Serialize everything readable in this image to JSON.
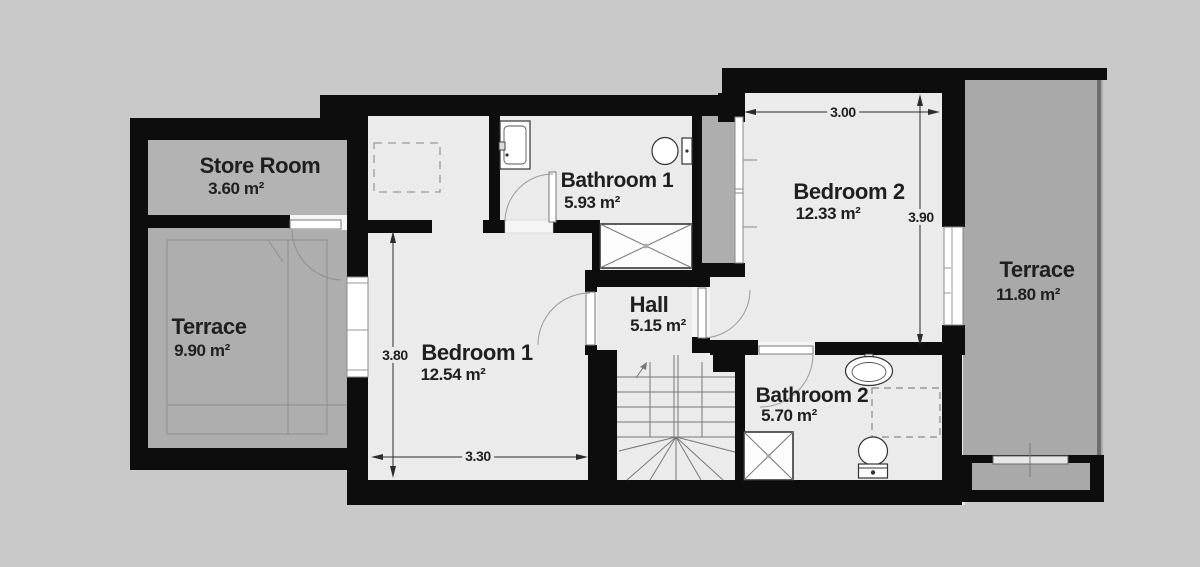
{
  "plan": {
    "type": "floor-plan",
    "rooms": [
      {
        "id": "store-room",
        "name": "Store Room",
        "area": "3.60 m²"
      },
      {
        "id": "terrace-left",
        "name": "Terrace",
        "area": "9.90 m²"
      },
      {
        "id": "bedroom-1",
        "name": "Bedroom 1",
        "area": "12.54 m²"
      },
      {
        "id": "bathroom-1",
        "name": "Bathroom 1",
        "area": "5.93 m²"
      },
      {
        "id": "hall",
        "name": "Hall",
        "area": "5.15 m²"
      },
      {
        "id": "bedroom-2",
        "name": "Bedroom 2",
        "area": "12.33 m²"
      },
      {
        "id": "bathroom-2",
        "name": "Bathroom 2",
        "area": "5.70 m²"
      },
      {
        "id": "terrace-right",
        "name": "Terrace",
        "area": "11.80 m²"
      }
    ],
    "dimensions": [
      {
        "id": "bedroom2-width",
        "value": "3.00",
        "orientation": "horizontal"
      },
      {
        "id": "bedroom2-height",
        "value": "3.90",
        "orientation": "vertical"
      },
      {
        "id": "bedroom1-height",
        "value": "3.80",
        "orientation": "vertical"
      },
      {
        "id": "bedroom1-width",
        "value": "3.30",
        "orientation": "horizontal"
      }
    ],
    "fixtures": [
      "sink",
      "toilet",
      "shower",
      "staircase",
      "wardrobe",
      "closet",
      "door",
      "window"
    ],
    "colors": {
      "background": "#c9c9c9",
      "floor": "#ebebeb",
      "wall": "#0d0d0d",
      "store_gray": "#b3b3b3",
      "terrace_gray": "#a9a9a9",
      "text": "#1f1f1f"
    }
  }
}
